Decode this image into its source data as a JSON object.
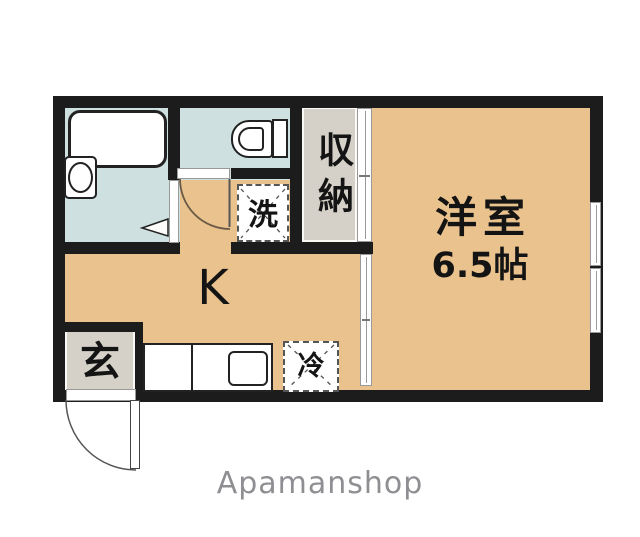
{
  "watermark": {
    "brand": "Apamanshop"
  },
  "floorplan": {
    "rooms": {
      "kitchen": {
        "label": "K"
      },
      "western_room": {
        "name": "洋室",
        "size": "6.5帖"
      },
      "closet": {
        "label": "収納"
      },
      "entrance": {
        "label": "玄"
      },
      "washer_box": {
        "label": "洗"
      },
      "fridge_box": {
        "label": "冷"
      }
    },
    "colors": {
      "wall": "#1c1c1c",
      "room_tan": "#eac28e",
      "wet_area_blue": "#cee0e0",
      "storage_gray": "#d5d1c9",
      "background": "#ffffff",
      "watermark_gray": "#8f8f93"
    }
  }
}
